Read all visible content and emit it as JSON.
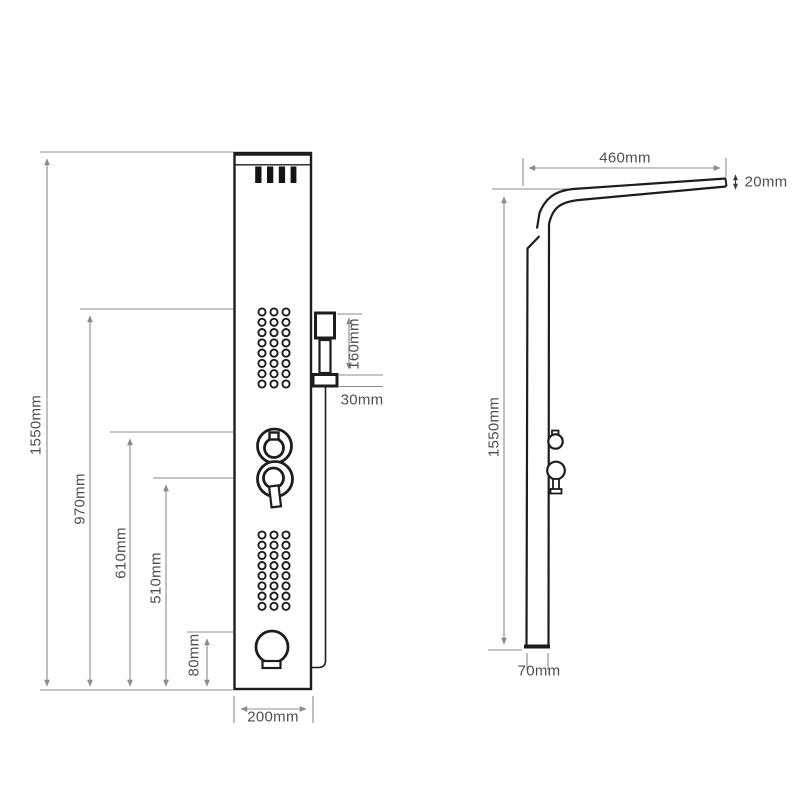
{
  "drawing": {
    "background": "#ffffff",
    "line_color": "#1d1d1d",
    "dimension_color": "#8c8c8c",
    "text_color": "#4f4f4f"
  },
  "front_view": {
    "dimensions": {
      "height_total": "1550mm",
      "height_to_jets": "970mm",
      "height_to_upper_knob": "610mm",
      "height_to_lower_knob": "510mm",
      "height_to_spout": "80mm",
      "panel_width": "200mm",
      "hand_shower_length": "160mm",
      "bracket_height": "30mm"
    }
  },
  "side_view": {
    "dimensions": {
      "arm_length": "460mm",
      "arm_thickness": "20mm",
      "height_total": "1550mm",
      "panel_depth": "70mm"
    }
  }
}
